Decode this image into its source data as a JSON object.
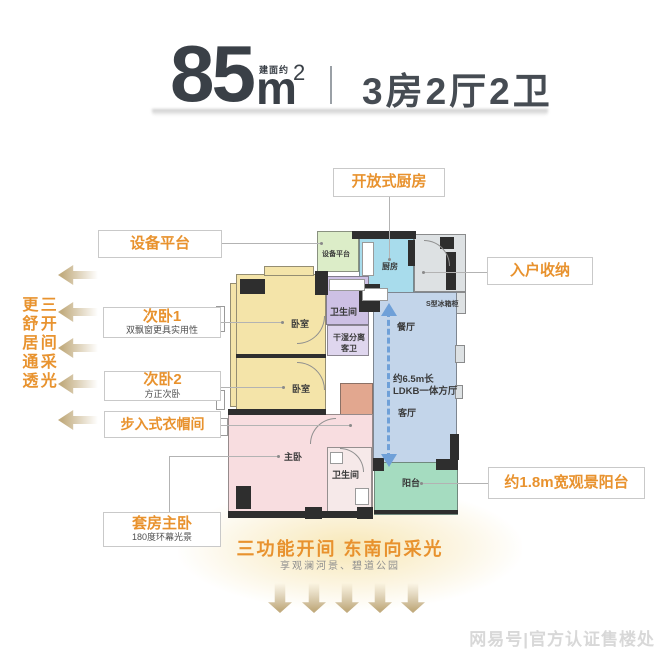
{
  "header": {
    "area_prefix": "建面约",
    "area_value": "85",
    "area_unit": "m",
    "area_sup": "2",
    "layout": "3房2厅2卫"
  },
  "left_tagline": {
    "col1": "三开间采光",
    "col2": "更舒居通透"
  },
  "callouts": {
    "equipment_platform": {
      "title": "设备平台"
    },
    "bedroom1": {
      "title": "次卧1",
      "subtitle": "双飘窗更具实用性"
    },
    "bedroom2": {
      "title": "次卧2",
      "subtitle": "方正次卧"
    },
    "walkin_closet": {
      "title": "步入式衣帽间"
    },
    "master_suite": {
      "title": "套房主卧",
      "subtitle": "180度环幕光景"
    },
    "open_kitchen": {
      "title": "开放式厨房"
    },
    "entry_storage": {
      "title": "入户收纳"
    },
    "view_balcony": {
      "title": "约1.8m宽观景阳台"
    }
  },
  "plan": {
    "equipment_platform": "设备平台",
    "kitchen": "厨房",
    "bathroom": "卫生间",
    "guest_bath_line1": "干湿分离",
    "guest_bath_line2": "客卫",
    "fridge_cabinet": "S型冰箱柜",
    "dining": "餐厅",
    "hall_line1": "约6.5m长",
    "hall_line2": "LDKB一体方厅",
    "living": "客厅",
    "bedroom1": "卧室",
    "bedroom2": "卧室",
    "master": "主卧",
    "master_bath": "卫生间",
    "balcony": "阳台"
  },
  "bottom": {
    "tagline": "三功能开间 东南向采光",
    "note": "享观澜河景、碧道公园"
  },
  "watermark": "网易号|官方认证售楼处",
  "colors": {
    "accent_orange": "#E8922E",
    "arrow_tan": "#C2AC7F",
    "arrow_blue": "#6FA0D8",
    "wall_dark": "#2E2E2E",
    "room_bedroom": "#F4E4A9",
    "room_kitchen": "#A8DCEC",
    "room_living": "#C3D5EA",
    "room_balcony": "#A5DCC0",
    "room_master": "#F8DDE0",
    "room_bath": "#CDC0E4",
    "room_guest_bath": "#DFD6EE",
    "room_closet": "#E2A78F",
    "room_equipment": "#DCEDC8",
    "room_entry": "#DDE1E3"
  }
}
